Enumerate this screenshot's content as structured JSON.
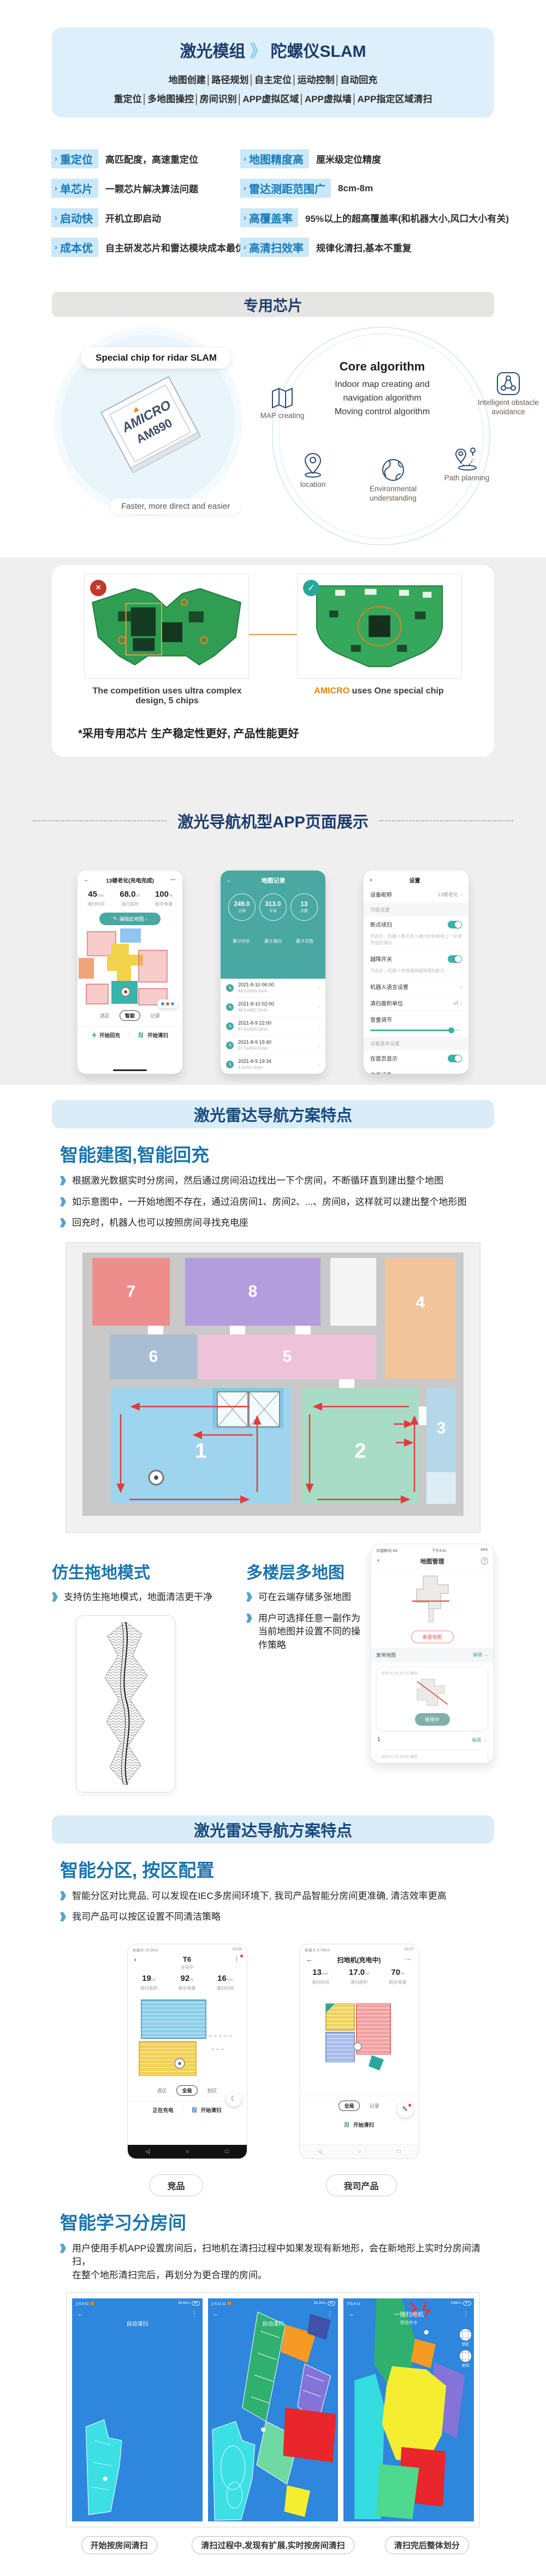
{
  "colors": {
    "accent_blue": "#1a74ae",
    "navy": "#1c3c6e",
    "teal": "#4aa8a2",
    "band_blue": "#d9ecf8",
    "badge_bg": "#cbe8f9",
    "orange": "#f08300",
    "map_blue": "#2e86dd",
    "red_arrow": "#e23b3b"
  },
  "glyphs": {
    "sep": "》",
    "chev": "›",
    "back": "←",
    "back2": "‹",
    "more_v": "⋮",
    "more_h": "···",
    "q": "?",
    "moon": "☾",
    "navb": "◁",
    "navh": "○",
    "navr": "□",
    "check": "✓",
    "cross": "×",
    "edit": "✎",
    "arrow": "→"
  },
  "hero": {
    "title_left": "激光模组",
    "title_right": "陀螺仪SLAM",
    "line1": "地图创建│路径规划│自主定位│运动控制│自动回充",
    "line2": "重定位│多地图操控│房间识别│APP虚拟区域│APP虚拟墙│APP指定区域清扫"
  },
  "features": [
    {
      "badge": "重定位",
      "desc": "高匹配度，高速重定位"
    },
    {
      "badge": "地图精度高",
      "desc": "厘米级定位精度"
    },
    {
      "badge": "单芯片",
      "desc": "一颗芯片解决算法问题"
    },
    {
      "badge": "雷达测距范围广",
      "desc": "8cm-8m"
    },
    {
      "badge": "启动快",
      "desc": "开机立即启动"
    },
    {
      "badge": "高覆盖率",
      "desc": "95%以上的超高覆盖率(和机器大小,风口大小有关)"
    },
    {
      "badge": "成本优",
      "desc": "自主研发芯片和雷达模块成本最优"
    },
    {
      "badge": "高清扫效率",
      "desc": "规律化清扫,基本不重复"
    }
  ],
  "chip": {
    "band_title": "专用芯片",
    "chip_label": "Special chip for ridar SLAM",
    "brand": "AMICRO",
    "model": "AM890",
    "chip_caption": "Faster, more direct and easier",
    "algo_title": "Core algorithm",
    "algo_l1": "Indoor map creating and",
    "algo_l2": "navigation algorithm",
    "algo_l3": "Moving control algorithm",
    "icon_map": "MAP creating",
    "icon_obstacle": "Intelligent obstacle avoidance",
    "icon_location": "location",
    "icon_env": "Environmental understanding",
    "icon_path": "Path planning"
  },
  "boards": {
    "left_caption": "The competition uses ultra complex design, 5 chips",
    "brand": "AMICRO",
    "right_caption": " uses One special chip",
    "footnote": "*采用专用芯片 生产稳定性更好, 产品性能更好"
  },
  "app": {
    "title": "激光导航机型APP页面展示",
    "phone1": {
      "title": "13楼老化(充电完成)",
      "stats": [
        {
          "v": "45",
          "u": "min",
          "l": "清扫时间"
        },
        {
          "v": "68.0",
          "u": "㎡",
          "l": "清扫面积"
        },
        {
          "v": "100",
          "u": "%",
          "l": "剩余电量"
        }
      ],
      "edit_btn": "编辑此地图 ›",
      "tabs": [
        "选区",
        "智能",
        "记录"
      ],
      "act1": "开始回充",
      "act2": "开始清扫"
    },
    "phone2": {
      "title": "地图记录",
      "circles": [
        {
          "v": "249.0",
          "u": "分钟",
          "l": "累计时长"
        },
        {
          "v": "313.0",
          "u": "平米",
          "l": "累计清扫"
        },
        {
          "v": "13",
          "u": "次数",
          "l": "累计次数"
        }
      ],
      "records": [
        {
          "t": "2021-8-10 06:00",
          "d": "68.0㎡|45.0min"
        },
        {
          "t": "2021-8-10 02:00",
          "d": "68.0㎡|47.0min"
        },
        {
          "t": "2021-8-9 22:00",
          "d": "67.0㎡|46.0min"
        },
        {
          "t": "2021-8-9 19:40",
          "d": "67.0㎡|54.0min"
        },
        {
          "t": "2021-8-9 19:34",
          "d": "4.0㎡|1.0min"
        },
        {
          "t": "2021-8-9 17:17",
          "d": "6.0㎡|13.0min"
        },
        {
          "t": "2021-8-9 17:03",
          "d": "3.0㎡|7.0min"
        }
      ]
    },
    "phone3": {
      "title": "设置",
      "rows": {
        "r1_label": "设备昵称",
        "r1_value": "13楼老化",
        "sec1": "功能设置",
        "r2_label": "断点续扫",
        "r2_desc": "开启后，机器人再次进入清扫时会继续上一次未完成的清扫",
        "r3_label": "越障开关",
        "r3_desc": "开启后，机器人将增强跨越障碍的能力",
        "r4_label": "机器人语言设置",
        "r5_label": "清扫面积单位",
        "r5_value": "㎡",
        "r6_label": "音量调节",
        "sec2": "设备基本设置",
        "r7_label": "在首页显示",
        "r8_label": "共享设备",
        "r9_label": "房间设置",
        "r9_value": "default room",
        "r10_label": "检查更新"
      }
    }
  },
  "band1": "激光雷达导航方案特点",
  "mapping": {
    "heading": "智能建图,智能回充",
    "bullets": [
      "根据激光数据实时分房间，然后通过房间沿边找出一下个房间，不断循环直到建出整个地图",
      "如示意图中，一开始地图不存在，通过沿房间1、房间2、...、房间8，这样就可以建出整个地形图",
      "回充时，机器人也可以按照房间寻找充电座"
    ],
    "rooms": {
      "r1": "1",
      "r2": "2",
      "r3": "3",
      "r4": "4",
      "r5": "5",
      "r6": "6",
      "r7": "7",
      "r8": "8"
    }
  },
  "mop": {
    "heading": "仿生拖地模式",
    "bullet": "支持仿生拖地模式，地面清洁更干净"
  },
  "multimap": {
    "heading": "多楼层多地图",
    "bullets": [
      "可在云端存储多张地图",
      "用户可选择任意一副作为当前地图并设置不同的操作策略"
    ],
    "phone": {
      "carrier": "中国移动 4G",
      "time": "下午4:41",
      "battery": "44%",
      "title": "地图管理",
      "reset_btn": "重置地图",
      "reuse_label": "复用地图",
      "edit_link": "编辑 →",
      "card1_date": "2020.4.15 15:13 保存",
      "in_use_btn": "使用中",
      "index_label": "1",
      "card2_date": "2020.4.15 16:03 保存"
    }
  },
  "band2": "激光雷达导航方案特点",
  "zoning": {
    "heading": "智能分区, 按区配置",
    "bullets": [
      "智能分区对比竞品, 可以发现在IEC多房间环境下, 我司产品智能分房间更准确, 清洁效率更高",
      "我司产品可以按区设置不同清洁策略"
    ],
    "phoneA": {
      "status_l": "未插卡 15.2K/s",
      "status_r": "10:54",
      "title": "T6",
      "sub": "充电中",
      "stats": [
        {
          "v": "19",
          "u": "㎡",
          "l": "清扫面积"
        },
        {
          "v": "92",
          "u": "%",
          "l": "剩余电量"
        },
        {
          "v": "16",
          "u": "min",
          "l": "清扫时间"
        }
      ],
      "tabs": [
        "选区",
        "全局",
        "划区"
      ],
      "act1": "正在充电",
      "act2": "开始清扫",
      "label": "竞品"
    },
    "phoneB": {
      "status_l": "未插卡 6.78K/s",
      "status_r": "10:27",
      "title": "扫地机(充电中)",
      "stats": [
        {
          "v": "13",
          "u": "min",
          "l": "清扫时间"
        },
        {
          "v": "17.0",
          "u": "㎡",
          "l": "清扫面积"
        },
        {
          "v": "70",
          "u": "%",
          "l": "剩余电量"
        }
      ],
      "tabs": [
        "全局",
        "记录"
      ],
      "act": "开始清扫",
      "label": "我司产品"
    }
  },
  "learning": {
    "heading": "智能学习分房间",
    "line1": "用户使用手机APP设置房间后，扫地机在清扫过程中如果发现有新地形，会在新地形上实时分房间清扫，",
    "line2": "在整个地形清扫完后，再划分为更合理的房间。",
    "screens": [
      {
        "status_l": "上午9:52",
        "status_r": "36.6K/s",
        "batt": "64",
        "title": "自动清扫",
        "caption": "开始按房间清扫"
      },
      {
        "status_l": "上午11:11",
        "status_r": "58.2K/s",
        "batt": "82",
        "title": "自动清扫",
        "caption": "清扫过程中,发现有扩展,实时按房间清扫"
      },
      {
        "status_l": "下午4:01",
        "status_r": "106K/s",
        "batt": "47",
        "title": "一微扫地机",
        "sub": "等待命令",
        "side1": "划区",
        "side2": "房间",
        "caption": "清扫完后整体划分"
      }
    ]
  }
}
